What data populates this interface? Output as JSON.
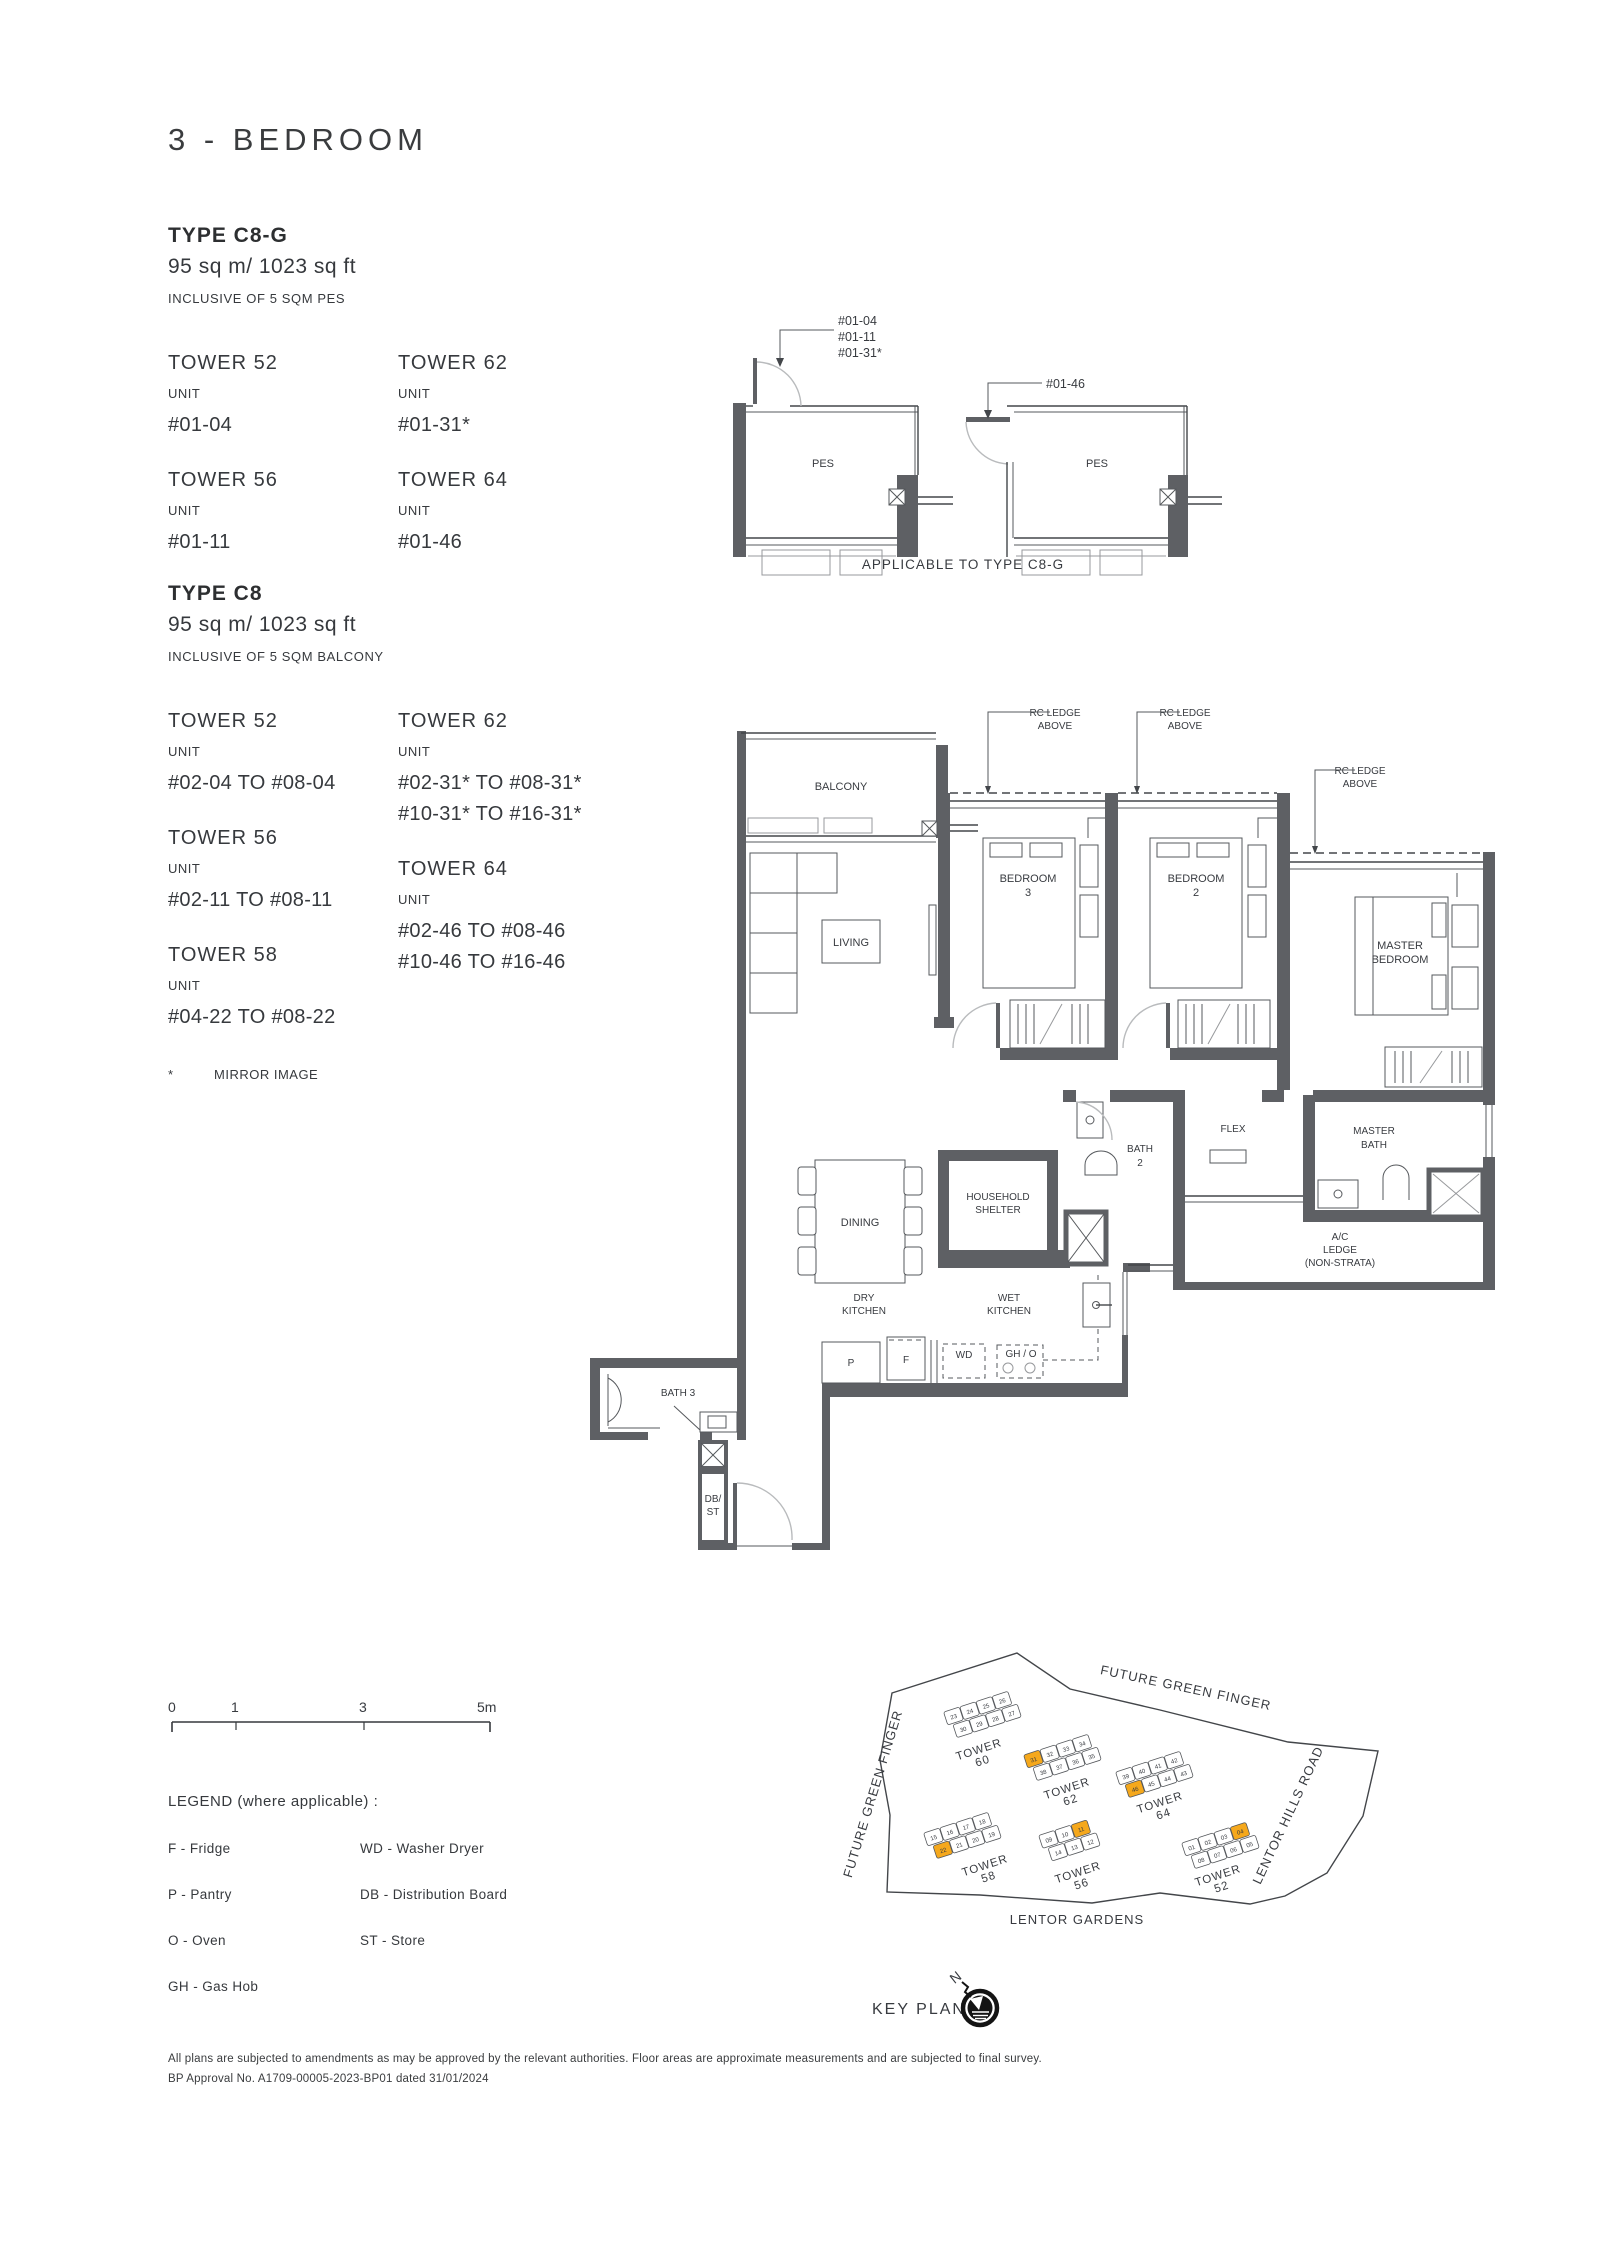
{
  "page": {
    "title": "3 - BEDROOM",
    "disclaimer_line1": "All plans are subjected to amendments as may be approved by the relevant authorities. Floor areas are approximate measurements and are subjected to final survey.",
    "disclaimer_line2": "BP Approval No. A1709-00005-2023-BP01 dated 31/01/2024"
  },
  "section_c8g": {
    "heading": "TYPE C8-G",
    "area": "95 sq m/ 1023 sq ft",
    "note": "INCLUSIVE OF 5 SQM PES",
    "columns": [
      [
        {
          "tower": "TOWER 52",
          "unit_label": "UNIT",
          "units": [
            "#01-04"
          ]
        },
        {
          "tower": "TOWER 56",
          "unit_label": "UNIT",
          "units": [
            "#01-11"
          ]
        }
      ],
      [
        {
          "tower": "TOWER 62",
          "unit_label": "UNIT",
          "units": [
            "#01-31*"
          ]
        },
        {
          "tower": "TOWER 64",
          "unit_label": "UNIT",
          "units": [
            "#01-46"
          ]
        }
      ]
    ]
  },
  "section_c8": {
    "heading": "TYPE C8",
    "area": "95 sq m/ 1023 sq ft",
    "note": "INCLUSIVE OF 5 SQM BALCONY",
    "columns": [
      [
        {
          "tower": "TOWER 52",
          "unit_label": "UNIT",
          "units": [
            "#02-04 TO #08-04"
          ]
        },
        {
          "tower": "TOWER 56",
          "unit_label": "UNIT",
          "units": [
            "#02-11 TO #08-11"
          ]
        },
        {
          "tower": "TOWER 58",
          "unit_label": "UNIT",
          "units": [
            "#04-22 TO #08-22"
          ]
        }
      ],
      [
        {
          "tower": "TOWER 62",
          "unit_label": "UNIT",
          "units": [
            "#02-31* TO #08-31*",
            "#10-31* TO #16-31*"
          ]
        },
        {
          "tower": "TOWER 64",
          "unit_label": "UNIT",
          "units": [
            "#02-46 TO #08-46",
            "#10-46 TO #16-46"
          ]
        }
      ]
    ],
    "footnote_symbol": "*",
    "footnote": "MIRROR IMAGE"
  },
  "mini_plan": {
    "caption": "APPLICABLE TO TYPE C8-G",
    "left": {
      "room": "PES",
      "callout": [
        "#01-04",
        "#01-11",
        "#01-31*"
      ]
    },
    "right": {
      "room": "PES",
      "callout": [
        "#01-46"
      ]
    }
  },
  "floor_plan": {
    "labels": {
      "balcony": "BALCONY",
      "living": "LIVING",
      "bedroom3": [
        "BEDROOM",
        "3"
      ],
      "bedroom2": [
        "BEDROOM",
        "2"
      ],
      "master_bedroom": [
        "MASTER",
        "BEDROOM"
      ],
      "dining": "DINING",
      "household_shelter": [
        "HOUSEHOLD",
        "SHELTER"
      ],
      "bath2": [
        "BATH",
        "2"
      ],
      "flex": "FLEX",
      "master_bath": [
        "MASTER",
        "BATH"
      ],
      "ac_ledge": [
        "A/C",
        "LEDGE",
        "(NON-STRATA)"
      ],
      "dry_kitchen": [
        "DRY",
        "KITCHEN"
      ],
      "wet_kitchen": [
        "WET",
        "KITCHEN"
      ],
      "bath3": "BATH 3",
      "db_st": [
        "DB/",
        "ST"
      ],
      "p": "P",
      "f": "F",
      "wd": "WD",
      "gh_o": "GH / O",
      "rc_ledge": [
        "RC LEDGE",
        "ABOVE"
      ]
    }
  },
  "scale_bar": {
    "ticks": [
      "0",
      "1",
      "3",
      "5m"
    ]
  },
  "legend": {
    "heading": "LEGEND (where applicable) :",
    "col1": [
      "F - Fridge",
      "P - Pantry",
      "O - Oven",
      "GH - Gas Hob"
    ],
    "col2": [
      "WD - Washer Dryer",
      "DB - Distribution Board",
      "ST - Store"
    ]
  },
  "key_plan": {
    "label": "KEY PLAN",
    "north": "N",
    "highlight_color": "#F5A81C",
    "roads": {
      "top": "FUTURE GREEN FINGER",
      "left": "FUTURE GREEN FINGER",
      "right": "LENTOR HILLS ROAD",
      "bottom": "LENTOR  GARDENS"
    },
    "towers": [
      {
        "name": [
          "TOWER",
          "60"
        ],
        "x": 160,
        "y": 103,
        "rot": -18,
        "label_x": 160,
        "label_y": 141,
        "rows": [
          [
            "23",
            "24",
            "25",
            "26"
          ],
          [
            "30",
            "29",
            "28",
            "27"
          ]
        ],
        "highlight": []
      },
      {
        "name": [
          "TOWER",
          "62"
        ],
        "x": 240,
        "y": 146,
        "rot": -18,
        "label_x": 248,
        "label_y": 180,
        "rows": [
          [
            "31",
            "32",
            "33",
            "34"
          ],
          [
            "38",
            "37",
            "36",
            "35"
          ]
        ],
        "highlight": [
          "31"
        ]
      },
      {
        "name": [
          "TOWER",
          "64"
        ],
        "x": 332,
        "y": 163,
        "rot": -18,
        "label_x": 341,
        "label_y": 194,
        "rows": [
          [
            "39",
            "40",
            "41",
            "42"
          ],
          [
            "46",
            "45",
            "44",
            "43"
          ]
        ],
        "highlight": [
          "46"
        ]
      },
      {
        "name": [
          "TOWER",
          "58"
        ],
        "x": 140,
        "y": 224,
        "rot": -18,
        "label_x": 166,
        "label_y": 257,
        "rows": [
          [
            "15",
            "16",
            "17",
            "18"
          ],
          [
            "22",
            "21",
            "20",
            "19"
          ]
        ],
        "highlight": [
          "22"
        ]
      },
      {
        "name": [
          "TOWER",
          "56"
        ],
        "x": 247,
        "y": 229,
        "rot": -18,
        "label_x": 259,
        "label_y": 264,
        "rows": [
          [
            "09",
            "10",
            "11"
          ],
          [
            "14",
            "13",
            "12"
          ]
        ],
        "highlight": [
          "11"
        ]
      },
      {
        "name": [
          "TOWER",
          "52"
        ],
        "x": 398,
        "y": 234,
        "rot": -18,
        "label_x": 399,
        "label_y": 267,
        "rows": [
          [
            "01",
            "02",
            "03",
            "04"
          ],
          [
            "08",
            "07",
            "06",
            "05"
          ]
        ],
        "highlight": [
          "04"
        ]
      }
    ]
  }
}
